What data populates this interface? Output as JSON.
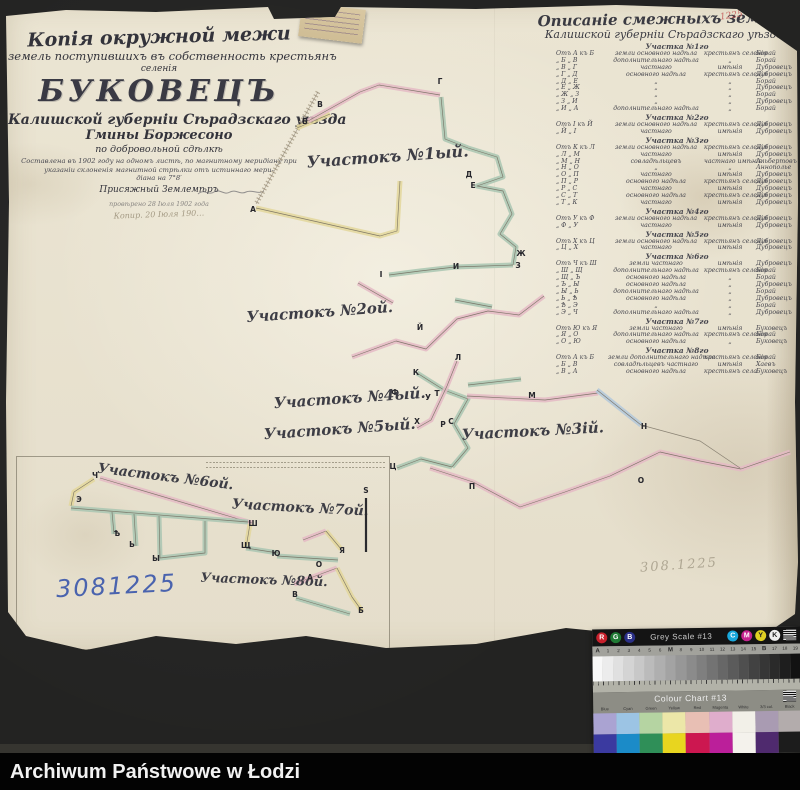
{
  "footer": {
    "text": "Archiwum Państwowe w Łodzi"
  },
  "title_block": {
    "line1": "Копія окружной межи",
    "line2": "земель поступившихъ въ собственность крестьянъ",
    "line3": "селенія",
    "name": "БУКОВЕЦЪ",
    "line5": "Калишской губерніи Сѣрадзскаго уѣзда",
    "line6": "Гмины Боржесоно",
    "line7": "по добровольной сдѣлкѣ",
    "line8": "Составлена въ 1902 году на одномъ листѣ, по магнитному меридіану при",
    "line9": "указаніи склоненія магнитной стрѣлки отъ истиннаго мери-",
    "line10": "діана на 7°8′",
    "line11": "Присяжный Землемѣръ",
    "line12": "провѣрено 28 Іюля 1902 года",
    "line13": "Копир. 20 Іюля 190…"
  },
  "desc_header": {
    "line1": "Описаніе смежныхъ земель",
    "line2": "Калишской губерніи Сѣрадзскаго уѣзда"
  },
  "description_table": {
    "sections": [
      {
        "header": "Участка №1го",
        "rows": [
          [
            "Отъ А къ Б",
            "земли основного надѣла",
            "крестьянъ селенія",
            "Борай"
          ],
          [
            "„  Б „ В",
            "дополнительнаго надѣла",
            "„",
            "Борай"
          ],
          [
            "„  В „ Г",
            "частнаго",
            "имѣнія",
            "Дубровецъ"
          ],
          [
            "„  Г „ Д",
            "основного надѣла",
            "крестьянъ селенія",
            "Дубровецъ"
          ],
          [
            "„  Д „ Е",
            "„",
            "„",
            "Борай"
          ],
          [
            "„  Е „ Ж",
            "„",
            "„",
            "Дубровецъ"
          ],
          [
            "„  Ж „ З",
            "„",
            "„",
            "Борай"
          ],
          [
            "„  З „ И",
            "„",
            "„",
            "Дубровецъ"
          ],
          [
            "„  И „ А",
            "дополнительнаго надѣла",
            "„",
            "Борай"
          ]
        ]
      },
      {
        "header": "Участка №2го",
        "rows": [
          [
            "Отъ І къ Й",
            "земли основного надѣла",
            "крестьянъ селенія",
            "Дубровецъ"
          ],
          [
            "„  Й „ І",
            "частнаго",
            "имѣнія",
            "Дубровецъ"
          ]
        ]
      },
      {
        "header": "Участка №3го",
        "rows": [
          [
            "Отъ К къ Л",
            "земли основного надѣла",
            "крестьянъ селенія",
            "Дубровецъ"
          ],
          [
            "„  Л „ М",
            "частнаго",
            "имѣнія",
            "Дубровецъ"
          ],
          [
            "„  М „ Н",
            "совладѣльцевъ",
            "частнаго имѣнія",
            "Альбертовъ"
          ],
          [
            "„  Н „ О",
            "„",
            "„",
            "Аннополье"
          ],
          [
            "„  О „ П",
            "частнаго",
            "имѣнія",
            "Дубровецъ"
          ],
          [
            "„  П „ Р",
            "основного надѣла",
            "крестьянъ селенія",
            "Дубровецъ"
          ],
          [
            "„  Р „ С",
            "частнаго",
            "имѣнія",
            "Дубровецъ"
          ],
          [
            "„  С „ Т",
            "основного надѣла",
            "крестьянъ селенія",
            "Дубровецъ"
          ],
          [
            "„  Т „ К",
            "частнаго",
            "имѣнія",
            "Дубровецъ"
          ]
        ]
      },
      {
        "header": "Участка №4го",
        "rows": [
          [
            "Отъ У къ Ф",
            "земли основного надѣла",
            "крестьянъ селенія",
            "Дубровецъ"
          ],
          [
            "„  Ф „ У",
            "частнаго",
            "имѣнія",
            "Дубровецъ"
          ]
        ]
      },
      {
        "header": "Участка №5го",
        "rows": [
          [
            "Отъ Х къ Ц",
            "земли основного надѣла",
            "крестьянъ селенія",
            "Дубровецъ"
          ],
          [
            "„  Ц „ Х",
            "частнаго",
            "имѣнія",
            "Дубровецъ"
          ]
        ]
      },
      {
        "header": "Участка №6го",
        "rows": [
          [
            "Отъ Ч къ Ш",
            "земли частнаго",
            "имѣнія",
            "Дубровецъ"
          ],
          [
            "„  Ш „ Щ",
            "дополнительнаго надѣла",
            "крестьянъ селенія",
            "Борай"
          ],
          [
            "„  Щ „ Ъ",
            "основного надѣла",
            "„",
            "Борай"
          ],
          [
            "„  Ъ „ Ы",
            "основного надѣла",
            "„",
            "Дубровецъ"
          ],
          [
            "„  Ы „ Ь",
            "дополнительнаго надѣла",
            "„",
            "Борай"
          ],
          [
            "„  Ь „ Ѣ",
            "основного надѣла",
            "„",
            "Дубровецъ"
          ],
          [
            "„  Ѣ „ Э",
            "„",
            "„",
            "Борай"
          ],
          [
            "„  Э „ Ч",
            "дополнительнаго надѣла",
            "„",
            "Дубровецъ"
          ]
        ]
      },
      {
        "header": "Участка №7го",
        "rows": [
          [
            "Отъ Ю къ Я",
            "земли частнаго",
            "имѣнія",
            "Буковецъ"
          ],
          [
            "„  Я „ О",
            "дополнительнаго надѣла",
            "крестьянъ селенія",
            "Борай"
          ],
          [
            "„  О „ Ю",
            "основного надѣла",
            "„",
            "Буковецъ"
          ]
        ]
      },
      {
        "header": "Участка №8го",
        "rows": [
          [
            "Отъ А къ Б",
            "земли дополнительнаго надѣла",
            "крестьянъ селенія",
            "Борай"
          ],
          [
            "„  Б „ В",
            "совладѣльцевъ частнаго",
            "имѣнія",
            "Хаевъ"
          ],
          [
            "„  В „ А",
            "основного надѣла",
            "крестьянъ села",
            "Буковецъ"
          ]
        ]
      }
    ]
  },
  "marks": {
    "inventory_blue": "3081225",
    "pencil_number": "308.1225",
    "red_corner_number": "1225"
  },
  "map": {
    "chains": [
      {
        "c": "hatch",
        "pts": [
          [
            318,
            92
          ],
          [
            256,
            204
          ]
        ]
      },
      {
        "c": "yellow",
        "pts": [
          [
            256,
            208
          ],
          [
            380,
            236
          ],
          [
            397,
            231
          ],
          [
            400,
            181
          ]
        ]
      },
      {
        "c": "yellow",
        "pts": [
          [
            297,
            128
          ],
          [
            330,
            114
          ]
        ]
      },
      {
        "c": "pink",
        "pts": [
          [
            308,
            121
          ],
          [
            360,
            92
          ],
          [
            379,
            85
          ],
          [
            440,
            95
          ]
        ]
      },
      {
        "c": "green",
        "pts": [
          [
            441,
            97
          ],
          [
            445,
            139
          ],
          [
            468,
            148
          ],
          [
            497,
            157
          ],
          [
            503,
            177
          ],
          [
            477,
            186
          ],
          [
            503,
            191
          ],
          [
            512,
            214
          ],
          [
            500,
            234
          ],
          [
            516,
            247
          ],
          [
            513,
            265
          ]
        ]
      },
      {
        "c": "green",
        "pts": [
          [
            513,
            265
          ],
          [
            455,
            267
          ],
          [
            420,
            271
          ],
          [
            389,
            275
          ]
        ]
      },
      {
        "c": "pink",
        "pts": [
          [
            358,
            283
          ],
          [
            393,
            303
          ]
        ]
      },
      {
        "c": "pink",
        "pts": [
          [
            352,
            357
          ],
          [
            396,
            341
          ],
          [
            426,
            349
          ],
          [
            457,
            319
          ],
          [
            488,
            311
          ],
          [
            519,
            315
          ],
          [
            544,
            296
          ]
        ]
      },
      {
        "c": "green",
        "pts": [
          [
            455,
            300
          ],
          [
            492,
            307
          ]
        ]
      },
      {
        "c": "green",
        "pts": [
          [
            417,
            373
          ],
          [
            444,
            390
          ],
          [
            468,
            399
          ],
          [
            454,
            424
          ],
          [
            468,
            448
          ],
          [
            452,
            467
          ]
        ]
      },
      {
        "c": "pink",
        "pts": [
          [
            457,
            361
          ],
          [
            447,
            386
          ],
          [
            431,
            420
          ],
          [
            417,
            428
          ]
        ]
      },
      {
        "c": "pink",
        "pts": [
          [
            467,
            396
          ],
          [
            545,
            400
          ],
          [
            598,
            393
          ]
        ]
      },
      {
        "c": "green",
        "pts": [
          [
            468,
            385
          ],
          [
            521,
            379
          ]
        ]
      },
      {
        "c": "green",
        "pts": [
          [
            452,
            467
          ],
          [
            421,
            459
          ],
          [
            397,
            468
          ]
        ]
      },
      {
        "c": "pink",
        "pts": [
          [
            430,
            468
          ],
          [
            473,
            482
          ],
          [
            520,
            507
          ],
          [
            565,
            492
          ],
          [
            610,
            476
          ],
          [
            660,
            452
          ],
          [
            700,
            461
          ],
          [
            741,
            469
          ],
          [
            790,
            452
          ]
        ]
      },
      {
        "c": "blue",
        "pts": [
          [
            597,
            390
          ],
          [
            641,
            425
          ]
        ]
      },
      {
        "c": "line",
        "pts": [
          [
            641,
            425
          ],
          [
            700,
            441
          ],
          [
            740,
            468
          ]
        ]
      },
      {
        "c": "pink",
        "pts": [
          [
            100,
            478
          ],
          [
            252,
            523
          ]
        ]
      },
      {
        "c": "yellow",
        "pts": [
          [
            94,
            479
          ],
          [
            74,
            492
          ],
          [
            71,
            506
          ]
        ]
      },
      {
        "c": "green",
        "pts": [
          [
            71,
            508
          ],
          [
            248,
            522
          ]
        ]
      },
      {
        "c": "green",
        "pts": [
          [
            112,
            512
          ],
          [
            114,
            534
          ]
        ]
      },
      {
        "c": "green",
        "pts": [
          [
            134,
            514
          ],
          [
            136,
            546
          ]
        ]
      },
      {
        "c": "green",
        "pts": [
          [
            159,
            516
          ],
          [
            160,
            558
          ],
          [
            205,
            553
          ],
          [
            205,
            521
          ]
        ]
      },
      {
        "c": "yellow",
        "pts": [
          [
            250,
            524
          ],
          [
            246,
            548
          ]
        ]
      },
      {
        "c": "green",
        "pts": [
          [
            246,
            548
          ],
          [
            278,
            553
          ]
        ]
      },
      {
        "c": "pink",
        "pts": [
          [
            303,
            540
          ],
          [
            326,
            531
          ]
        ]
      },
      {
        "c": "yellow",
        "pts": [
          [
            326,
            531
          ],
          [
            341,
            549
          ]
        ]
      },
      {
        "c": "green",
        "pts": [
          [
            277,
            556
          ],
          [
            338,
            560
          ]
        ]
      },
      {
        "c": "pink",
        "pts": [
          [
            294,
            584
          ],
          [
            337,
            568
          ]
        ]
      },
      {
        "c": "yellow",
        "pts": [
          [
            337,
            568
          ],
          [
            352,
            597
          ],
          [
            362,
            611
          ]
        ]
      },
      {
        "c": "green",
        "pts": [
          [
            296,
            598
          ],
          [
            350,
            614
          ]
        ]
      }
    ],
    "letters": [
      [
        "А",
        253,
        212
      ],
      [
        "Б",
        305,
        124
      ],
      [
        "В",
        320,
        107
      ],
      [
        "Г",
        440,
        84
      ],
      [
        "Д",
        469,
        177
      ],
      [
        "Е",
        473,
        188
      ],
      [
        "Ж",
        521,
        256
      ],
      [
        "З",
        518,
        268
      ],
      [
        "И",
        456,
        269
      ],
      [
        "І",
        381,
        277
      ],
      [
        "Й",
        420,
        330
      ],
      [
        "К",
        416,
        375
      ],
      [
        "Л",
        458,
        360
      ],
      [
        "М",
        532,
        398
      ],
      [
        "Т",
        437,
        396
      ],
      [
        "У",
        428,
        400
      ],
      [
        "Ф",
        395,
        395
      ],
      [
        "Х",
        417,
        424
      ],
      [
        "Р",
        443,
        427
      ],
      [
        "С",
        451,
        424
      ],
      [
        "Ц",
        393,
        469
      ],
      [
        "П",
        472,
        489
      ],
      [
        "Н",
        644,
        429
      ],
      [
        "О",
        641,
        483
      ],
      [
        "Ч",
        95,
        478
      ],
      [
        "Э",
        79,
        502
      ],
      [
        "Ѣ",
        117,
        536
      ],
      [
        "Ь",
        132,
        547
      ],
      [
        "Ы",
        156,
        561
      ],
      [
        "Ш",
        253,
        526
      ],
      [
        "Щ",
        246,
        548
      ],
      [
        "Ю",
        276,
        556
      ],
      [
        "Я",
        342,
        553
      ],
      [
        "О",
        319,
        567
      ],
      [
        "А",
        310,
        580
      ],
      [
        "В",
        295,
        597
      ],
      [
        "Б",
        361,
        613
      ]
    ],
    "labels": [
      {
        "t": "Участокъ №1ый.",
        "x": 388,
        "y": 162,
        "s": 16,
        "r": -4
      },
      {
        "t": "Участокъ №2ой.",
        "x": 320,
        "y": 317,
        "s": 15,
        "r": -4
      },
      {
        "t": "Участокъ №3ій.",
        "x": 533,
        "y": 436,
        "s": 15,
        "r": -3
      },
      {
        "t": "Участокъ №4ый.",
        "x": 350,
        "y": 403,
        "s": 15,
        "r": -4
      },
      {
        "t": "Участокъ №5ый.",
        "x": 340,
        "y": 434,
        "s": 15,
        "r": -4
      },
      {
        "t": "Участокъ №6ой.",
        "x": 165,
        "y": 481,
        "s": 14,
        "r": 7
      },
      {
        "t": "Участокъ №7ой.",
        "x": 300,
        "y": 512,
        "s": 14,
        "r": 3
      },
      {
        "t": "Участокъ №8ой.",
        "x": 264,
        "y": 584,
        "s": 13,
        "r": 2
      }
    ],
    "scale_bar": {
      "x": 366,
      "y1": 498,
      "y2": 552,
      "label": "S",
      "ly": 493
    }
  },
  "calibration": {
    "grey_title": "Grey Scale #13",
    "colour_title": "Colour Chart #13",
    "rgb": [
      {
        "l": "R",
        "c": "#c8202c"
      },
      {
        "l": "G",
        "c": "#1f7a34"
      },
      {
        "l": "B",
        "c": "#2a2f86"
      }
    ],
    "cmyk": [
      {
        "l": "C",
        "c": "#19a8dc"
      },
      {
        "l": "M",
        "c": "#c4238f"
      },
      {
        "l": "Y",
        "c": "#e0d023",
        "dark": true
      },
      {
        "l": "K",
        "c": "#efefef",
        "dark": true
      }
    ],
    "ticks": [
      "A",
      "1",
      "2",
      "3",
      "4",
      "5",
      "6",
      "M",
      "8",
      "9",
      "10",
      "11",
      "12",
      "13",
      "14",
      "15",
      "B",
      "17",
      "18",
      "19"
    ],
    "labels": [
      "Blue",
      "Cyan",
      "Green",
      "Yellow",
      "Red",
      "Magenta",
      "White",
      "3/3 col.",
      "Black"
    ],
    "light": [
      "#aaa3d2",
      "#9cc4e4",
      "#b5d4a2",
      "#ece7a8",
      "#e8bfb4",
      "#dfadcc",
      "#f2f0e8",
      "#a99bb2",
      "#b3acac"
    ],
    "full": [
      "#3b3aa0",
      "#1b8bc8",
      "#2f8f58",
      "#e8d51f",
      "#cc1750",
      "#bb1f9a",
      "#f4f2ec",
      "#4f2a6e",
      "#1c1c1c"
    ]
  }
}
